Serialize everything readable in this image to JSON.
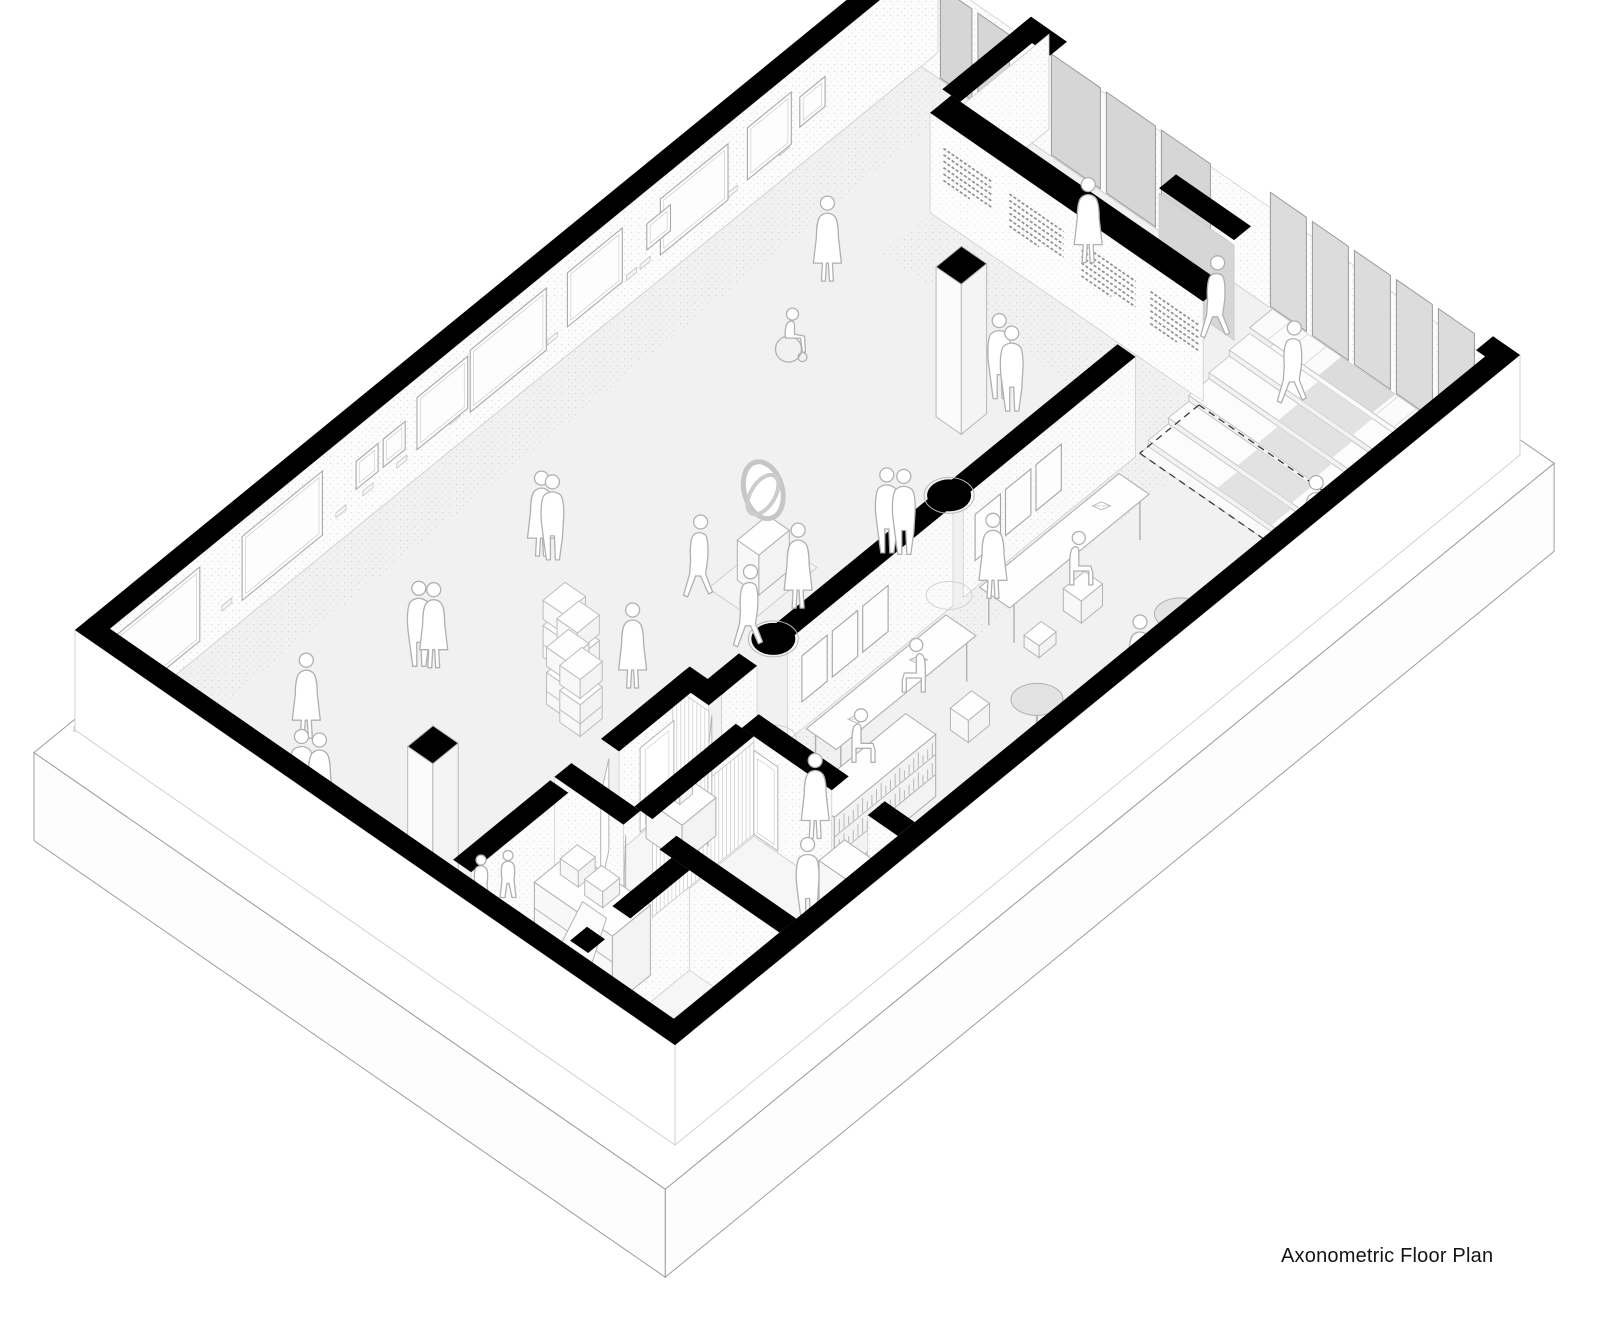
{
  "meta": {
    "title_label": "Axonometric Floor Plan"
  },
  "drawing": {
    "colors": {
      "background": "#ffffff",
      "wall": "#000000",
      "floor": "#f1f1f2",
      "floor_lobby": "#fafafa",
      "floor_service": "#f6f6f6",
      "panel_gray": "#d6d6d6",
      "glass_gray": "#dcdcdc",
      "edge": "#9e9e9e",
      "edge_light": "#c9c9c9",
      "furniture": "#b0b0b0",
      "people": "#b0b0b0",
      "table_top": "#e3e3e3",
      "stipple": "#c8c8c8",
      "text_line": "#8f8f8f",
      "dash": "#3a3a3a"
    },
    "axonometry": {
      "origin": [
        920,
        40
      ],
      "axis_u": [
        600,
        415
      ],
      "axis_v": [
        -845,
        690
      ],
      "wall_height": 100,
      "slab_depth": 88
    },
    "slab": {
      "p1": -0.012,
      "q1": -0.012,
      "p2": 1.04,
      "q2": 1.04
    },
    "floors": {
      "main": [
        0.03,
        0.02,
        0.97,
        0.98
      ],
      "lobby": [
        0.655,
        0.02,
        0.97,
        0.205
      ],
      "service": [
        0.625,
        0.715,
        0.97,
        0.98
      ],
      "stipple_strips": [
        [
          0.032,
          0.02,
          0.105,
          0.98
        ],
        [
          0.655,
          0.21,
          0.712,
          0.695
        ],
        [
          0.2,
          0.132,
          0.655,
          0.188
        ]
      ]
    },
    "perimeter": {
      "nw": [
        0,
        0,
        0.03,
        1
      ],
      "se": [
        0.97,
        0,
        1,
        1
      ],
      "sw": [
        0,
        0.98,
        1,
        1
      ],
      "ne_segments": [
        [
          0,
          0,
          0.06,
          0.02
        ],
        [
          0.185,
          0,
          0.245,
          0.02
        ],
        [
          0.955,
          0,
          1,
          0.02
        ]
      ]
    },
    "stub_walls": [
      {
        "rect": [
          0.185,
          0,
          0.215,
          0.105
        ],
        "face": {
          "axis": "p",
          "at": 0.215,
          "f1": 0,
          "f2": 0.105,
          "fill": "plain"
        }
      },
      {
        "rect": [
          0.49,
          0.045,
          0.615,
          0.065
        ],
        "face": {
          "axis": "q",
          "at": 0.065,
          "f1": 0.49,
          "f2": 0.615,
          "fill": "panel"
        }
      }
    ],
    "panels_ne": [
      {
        "p1": 0.065,
        "p2": 0.18,
        "n": 2,
        "h": 95,
        "tone": "panel_gray"
      },
      {
        "p1": 0.25,
        "p2": 0.515,
        "n": 3,
        "h": 105,
        "tone": "panel_gray"
      },
      {
        "p1": 0.615,
        "p2": 0.955,
        "n": 5,
        "h": 118,
        "tone": "glass_gray"
      }
    ],
    "text_wall": {
      "band": [
        0.2,
        0.105,
        0.655,
        0.13
      ],
      "face_q": 0.13,
      "blocks": [
        [
          0.225,
          0.305
        ],
        [
          0.335,
          0.425
        ],
        [
          0.455,
          0.545
        ],
        [
          0.57,
          0.65
        ]
      ],
      "rows": 6
    },
    "frames_nw": [
      [
        0.135,
        0.03,
        40,
        30
      ],
      [
        0.175,
        0.052,
        30,
        52
      ],
      [
        0.25,
        0.08,
        26,
        56
      ],
      [
        0.318,
        0.028,
        42,
        26
      ],
      [
        0.375,
        0.065,
        30,
        54
      ],
      [
        0.465,
        0.09,
        24,
        62
      ],
      [
        0.558,
        0.06,
        30,
        52
      ],
      [
        0.632,
        0.026,
        40,
        28
      ],
      [
        0.664,
        0.026,
        40,
        28
      ],
      [
        0.73,
        0.095,
        22,
        64
      ],
      [
        0.875,
        0.125,
        16,
        74
      ]
    ],
    "partition": {
      "p1": 0.625,
      "p2": 0.655,
      "segments": [
        [
          0.21,
          0.414
        ],
        [
          0.426,
          0.622
        ],
        [
          0.658,
          0.7
        ]
      ],
      "columns_q": [
        0.42,
        0.628
      ],
      "face_p": 0.655,
      "frames_q": [
        0.3,
        0.336,
        0.372,
        0.505,
        0.541,
        0.577
      ],
      "frame_w": 0.03,
      "frame_h": 46,
      "frame_lift": 30
    },
    "stairs": {
      "p1": 0.655,
      "p2": 0.955,
      "landing": [
        0.655,
        0.025,
        0.955,
        0.075
      ],
      "landing_z": 36,
      "tread_q0": 0.075,
      "tread_dq": 0.024,
      "tread_z": [
        30,
        24,
        18,
        12,
        6
      ],
      "runner": [
        0.77,
        0.86
      ]
    },
    "dashes": [
      [
        [
          0.655,
          0.135
        ],
        [
          0.655,
          0.205
        ]
      ],
      [
        [
          0.655,
          0.205
        ],
        [
          0.985,
          0.205
        ]
      ],
      [
        [
          0.655,
          0.135
        ],
        [
          0.985,
          0.135
        ]
      ]
    ],
    "service": {
      "bands": [
        [
          0.595,
          0.7,
          0.625,
          0.8
        ],
        [
          0.595,
          0.86,
          0.625,
          0.975
        ],
        [
          0.595,
          0.695,
          0.655,
          0.715
        ],
        [
          0.71,
          0.695,
          0.86,
          0.715
        ],
        [
          0.92,
          0.695,
          0.97,
          0.715
        ],
        [
          0.595,
          0.835,
          0.71,
          0.855
        ],
        [
          0.77,
          0.835,
          0.97,
          0.855
        ],
        [
          0.7,
          0.715,
          0.73,
          0.835
        ],
        [
          0.79,
          0.855,
          0.82,
          0.925
        ],
        [
          0.79,
          0.955,
          0.82,
          0.975
        ]
      ],
      "louvers": [
        {
          "axis": "p",
          "at": 0.73,
          "f1": 0.715,
          "f2": 0.835
        },
        {
          "axis": "q",
          "at": 0.715,
          "f1": 0.595,
          "f2": 0.655
        }
      ],
      "door_leaves": [
        [
          0.615,
          0.805,
          0.648,
          0.838
        ],
        [
          0.66,
          0.715,
          0.7,
          0.748
        ],
        [
          0.715,
          0.856,
          0.755,
          0.886
        ],
        [
          0.795,
          0.928,
          0.818,
          0.958
        ]
      ],
      "door_frames": [
        {
          "axis": "p",
          "at": 0.625,
          "f1": 0.735,
          "f2": 0.775
        },
        {
          "axis": "q",
          "at": 0.715,
          "f1": 0.73,
          "f2": 0.77
        }
      ]
    },
    "shelf_unit": {
      "rect": [
        0.66,
        0.88,
        0.79,
        0.925
      ],
      "h": 70,
      "boxes": [
        [
          0.675,
          0.885,
          0.705,
          0.905
        ],
        [
          0.72,
          0.888,
          0.75,
          0.908
        ]
      ],
      "lean_board": [
        [
          0.7,
          0.945
        ],
        [
          0.76,
          0.945
        ],
        [
          0.745,
          0.9
        ],
        [
          0.705,
          0.9
        ]
      ],
      "lean_h": 52
    },
    "counter": {
      "rect": [
        0.86,
        0.7,
        0.965,
        0.73
      ],
      "h": 40
    },
    "desk": {
      "rect": [
        0.635,
        0.735,
        0.695,
        0.775
      ],
      "h": 38
    },
    "bookshelf": {
      "rect": [
        0.8,
        0.585,
        0.85,
        0.705
      ],
      "h": 62,
      "bin": [
        0.865,
        0.715
      ]
    },
    "tables": [
      {
        "rect": [
          0.705,
          0.265,
          0.755,
          0.43
        ]
      },
      {
        "rect": [
          0.705,
          0.47,
          0.755,
          0.635
        ]
      }
    ],
    "books_on_tables": [
      [
        0.725,
        0.3
      ],
      [
        0.73,
        0.52
      ],
      [
        0.74,
        0.6
      ]
    ],
    "stools": [
      [
        0.76,
        0.345,
        0.79,
        0.37,
        22
      ],
      [
        0.765,
        0.4,
        0.79,
        0.42,
        12
      ],
      [
        0.79,
        0.5,
        0.82,
        0.525,
        22
      ]
    ],
    "round_tables": [
      [
        0.92,
        0.345
      ],
      [
        0.885,
        0.49
      ],
      [
        0.95,
        0.59
      ]
    ],
    "pedestals": [
      [
        0.505,
        0.935
      ],
      [
        0.452,
        0.272
      ]
    ],
    "loop_sculpture": {
      "center": [
        0.45,
        0.505
      ]
    },
    "stacks": [
      [
        0.345,
        0.665
      ],
      [
        0.378,
        0.672
      ],
      [
        0.4,
        0.7
      ],
      [
        0.432,
        0.707
      ]
    ],
    "people": [
      [
        "dress",
        0.185,
        0.241,
        0,
        0
      ],
      [
        "dress",
        0.4,
        0.085,
        0,
        0
      ],
      [
        "walk",
        0.6,
        0.075,
        0,
        0
      ],
      [
        "wheelchair",
        0.239,
        0.323,
        0,
        0
      ],
      [
        "stand",
        0.47,
        0.24,
        0,
        0
      ],
      [
        "stand",
        0.495,
        0.243,
        0,
        0
      ],
      [
        "walk",
        0.77,
        0.105,
        0,
        26
      ],
      [
        "dress",
        0.935,
        0.195,
        0,
        0
      ],
      [
        "stand",
        0.245,
        0.609,
        0,
        0
      ],
      [
        "dress",
        0.231,
        0.612,
        0,
        0
      ],
      [
        "walk",
        0.42,
        0.559,
        0,
        0
      ],
      [
        "walk",
        0.52,
        0.571,
        0,
        0
      ],
      [
        "dress",
        0.52,
        0.5135,
        0,
        0
      ],
      [
        "stand",
        0.539,
        0.422,
        0,
        0
      ],
      [
        "stand",
        0.556,
        0.414,
        0,
        0
      ],
      [
        "dress",
        0.459,
        0.666,
        0,
        0
      ],
      [
        "stand",
        0.242,
        0.765,
        0,
        0
      ],
      [
        "dress",
        0.257,
        0.758,
        0,
        0
      ],
      [
        "dress",
        0.22,
        0.8825,
        0,
        0
      ],
      [
        "stand",
        0.3,
        0.945,
        0,
        0
      ],
      [
        "dress",
        0.32,
        0.938,
        0,
        0
      ],
      [
        "child",
        0.5586,
        0.9162,
        0,
        0
      ],
      [
        "child",
        0.578,
        0.898,
        0,
        0
      ],
      [
        "dress",
        0.685,
        0.4,
        0,
        0
      ],
      [
        "seated",
        0.775,
        0.36,
        0,
        22
      ],
      [
        "dress",
        0.93,
        0.4,
        0,
        0
      ],
      [
        "seated",
        0.765,
        0.55,
        1,
        42
      ],
      [
        "seated",
        0.75,
        0.6,
        0,
        0
      ],
      [
        "stand",
        0.876,
        0.755,
        0,
        0
      ],
      [
        "dress",
        0.79,
        0.685,
        0,
        0
      ]
    ]
  }
}
